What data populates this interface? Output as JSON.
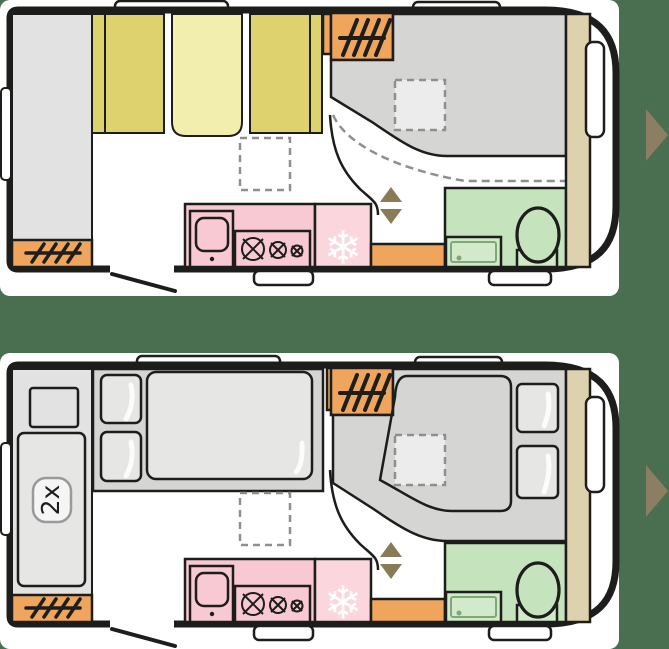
{
  "colors": {
    "background": "#4a6e50",
    "panel": "#ffffff",
    "wall": "#1d1d1b",
    "furniture_gray": "#e2e2e2",
    "bed_gray": "#d5d5d4",
    "mattress_gray": "#e6e6e5",
    "skylight_gray": "#ececec",
    "cushion_dark": "#ded26f",
    "cushion_pale": "#f2eead",
    "heater_orange": "#efa55c",
    "kitchen_pink": "#f8c9d2",
    "fridge_pink": "#fbd6dc",
    "bath_green": "#c5e3bd",
    "shower_green": "#d2e9ca",
    "shower_rim_green": "#7fa87a",
    "wardrobe_beige": "#ded2ae",
    "dash_gray": "#8f8f8f",
    "slide_arrow_olive": "#8a7b57",
    "nav_arrow_brown": "#8c7e63"
  },
  "plans": {
    "day": {
      "id": "day-layout"
    },
    "night": {
      "id": "night-layout",
      "bunk_label": "2x"
    }
  },
  "icons": {
    "snowflake_char": "❄"
  }
}
